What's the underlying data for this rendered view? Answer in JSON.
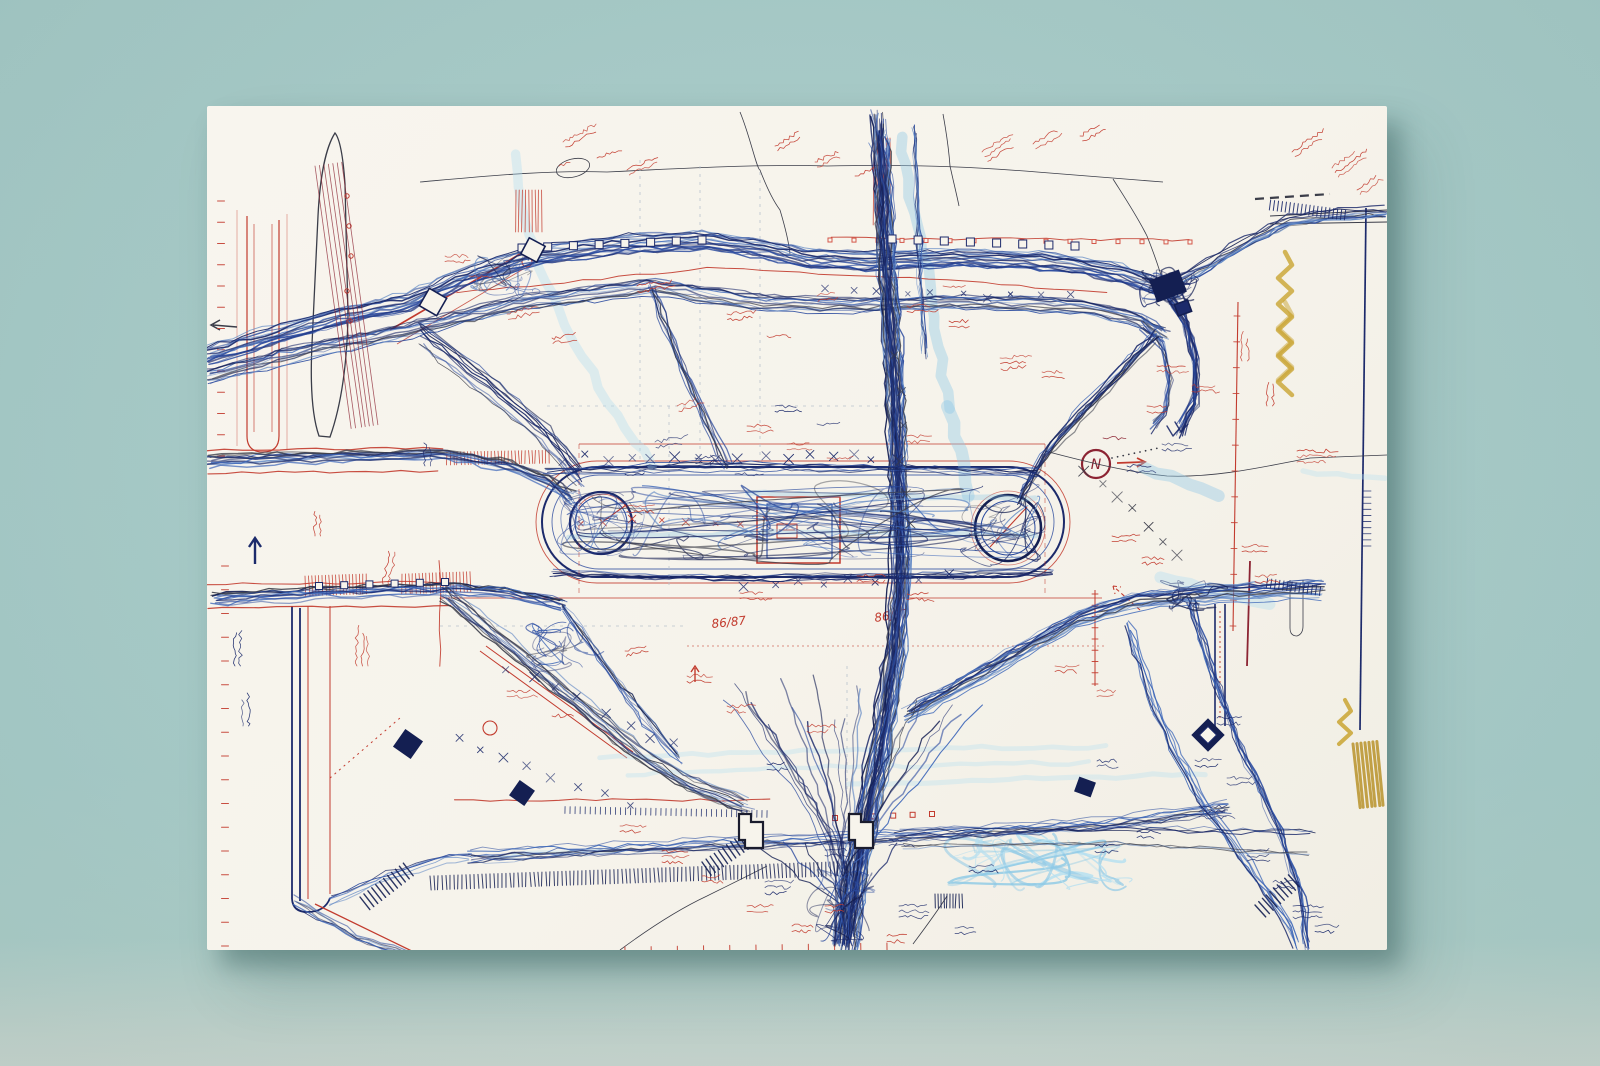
{
  "artwork": {
    "compass_label": "N",
    "annotation_year_left": "86/87",
    "annotation_year_right": "86/87"
  },
  "palette": {
    "backdrop": "#a9cdca",
    "backdrop_bottom": "#ccd8d1",
    "paper": "#f7f4ec",
    "shadow": "#2c5452",
    "ink_navy": "#1c2a6b",
    "ink_navy_dark": "#141f52",
    "ink_blue": "#2a4a9e",
    "ink_blue_mid": "#3c66b8",
    "ink_steel": "#5e86c4",
    "ink_cyan": "#8ec9e6",
    "ink_cyan_light": "#b5dff0",
    "ink_black": "#3b3d49",
    "ink_red": "#c23b2e",
    "ink_red_light": "#d4574a",
    "ink_maroon": "#8c2433",
    "ink_ochre": "#c9a431",
    "ink_ochre_dark": "#b8922a",
    "graphite": "#b9c2cc"
  }
}
